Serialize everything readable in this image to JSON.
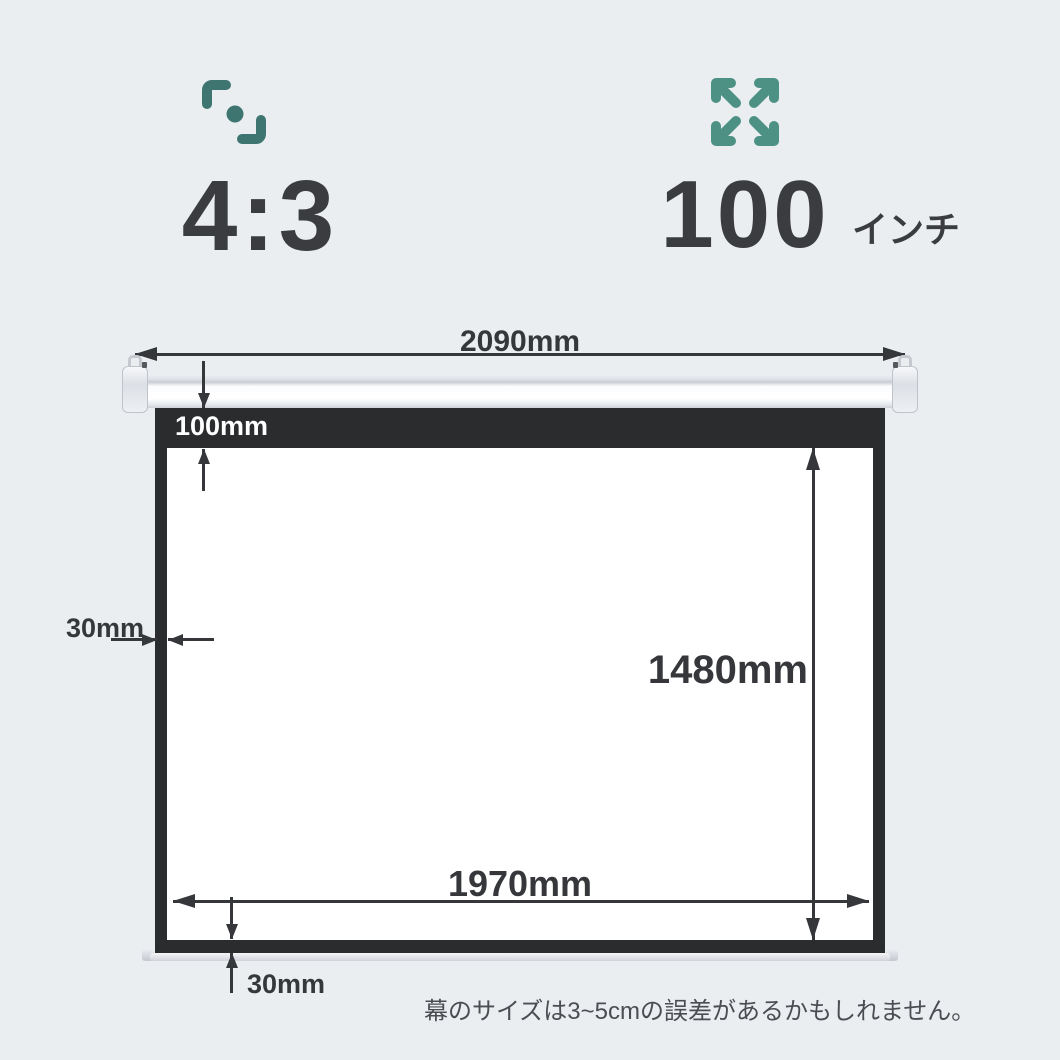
{
  "colors": {
    "background": "#ebeef1",
    "accent_teal_dark": "#3f7570",
    "accent_teal": "#4c9184",
    "ink": "#3b3c40",
    "dimension_ink": "#35373b",
    "frame_black": "#2b2c2e",
    "screen_white": "#ffffff"
  },
  "header": {
    "aspect_ratio": {
      "icon": "aspect-ratio-icon",
      "value": "4:3"
    },
    "screen_size": {
      "icon": "expand-arrows-icon",
      "value": "100",
      "unit": "インチ"
    }
  },
  "diagram": {
    "total_width": "2090mm",
    "top_border_height": "100mm",
    "side_border_width": "30mm",
    "viewing_height": "1480mm",
    "viewing_width": "1970mm",
    "bottom_border_height": "30mm"
  },
  "footnote": "幕のサイズは3~5cmの誤差があるかもしれません。"
}
